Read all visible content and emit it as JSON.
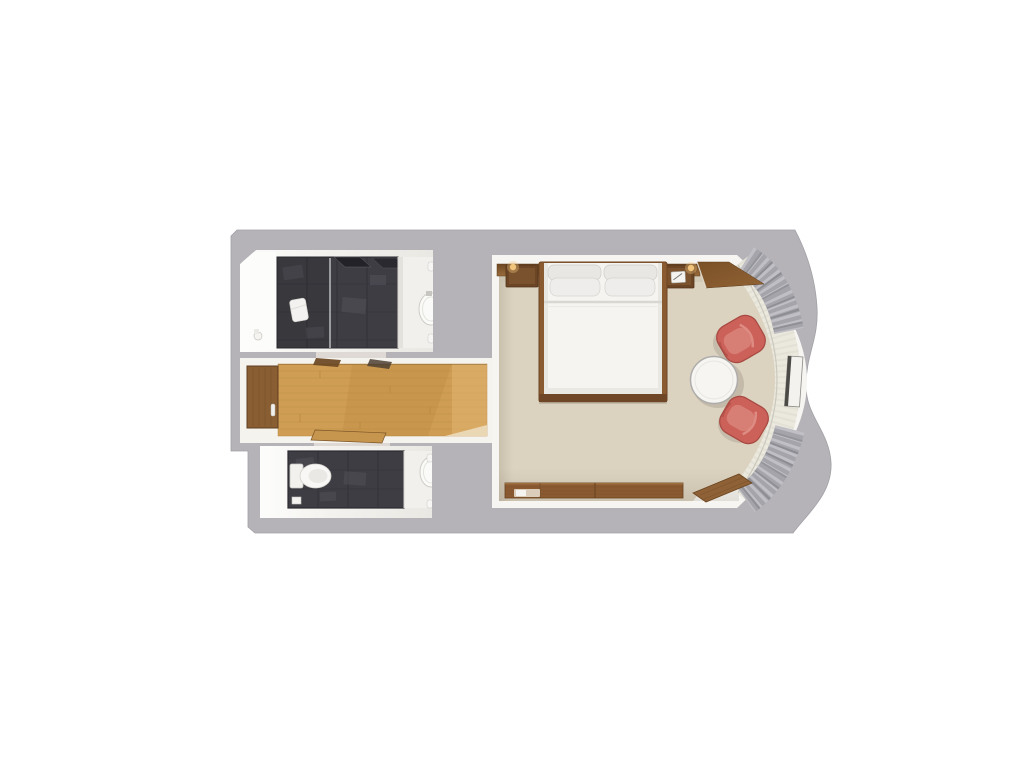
{
  "scene": {
    "title": "stateroom-floor-plan",
    "description": "Top-down 3D rendered floor plan of a cabin: two dark-tiled bathrooms and a wood-floor hallway on the left, main bedroom with queen bed, round table, two red tub chairs and a curved window bench with gray curtains on the right; wavy gray exterior wall on the right edge.",
    "background": "#ffffff"
  },
  "colors": {
    "wall_gray": "#b5b3b7",
    "wall_gray_edge": "#a2a0a5",
    "room_white": "#f6f5f2",
    "bath_light": "#fbfaf8",
    "tile_dark": "#3e3d43",
    "tile_line": "#2b2a30",
    "glass_line": "#cfd2d4",
    "wood_floor": "#cf9e54",
    "wood_plank_line": "#b8863e",
    "entry_door": "#8a5e33",
    "door_ajar": "#c6964f",
    "carpet": "#dbd2c0",
    "bed_linen": "#f5f4f1",
    "pillow": "#e9e7e4",
    "bed_frame": "#8a5a30",
    "headboard_wood": "#7c5329",
    "nightstand": "#6b4526",
    "lamp_glow": "#f6c87e",
    "chair_red": "#cb6159",
    "chair_cushion": "#d87f75",
    "table_white": "#f6f5f2",
    "bench_cream": "#ebe8dd",
    "curtain_gray": "#a5a4aa",
    "curtain_pleat_light": "#c0bfc5",
    "curtain_pleat_dark": "#86858c",
    "dresser_wood": "#8a5b31",
    "shelf_wood": "#8f6137",
    "vanity_white": "#f2f0ec",
    "fixture_white": "#f8f7f5"
  },
  "rooms": {
    "bathroom_top": {
      "label": "shower room",
      "features": [
        "dark tile shower",
        "glass partition",
        "towel",
        "vanity with sink"
      ]
    },
    "hallway": {
      "label": "entry hallway",
      "features": [
        "oak plank floor",
        "entry door",
        "bathroom doors ajar"
      ]
    },
    "bathroom_bottom": {
      "label": "toilet room",
      "features": [
        "toilet",
        "dark tile floor",
        "vanity with sink"
      ]
    },
    "bedroom": {
      "label": "main cabin",
      "features": [
        "queen bed with four pillows",
        "two nightstands with lamps",
        "round table",
        "two red tub chairs",
        "curved window bench",
        "gray curtains",
        "low dresser",
        "corner shelf"
      ]
    }
  }
}
